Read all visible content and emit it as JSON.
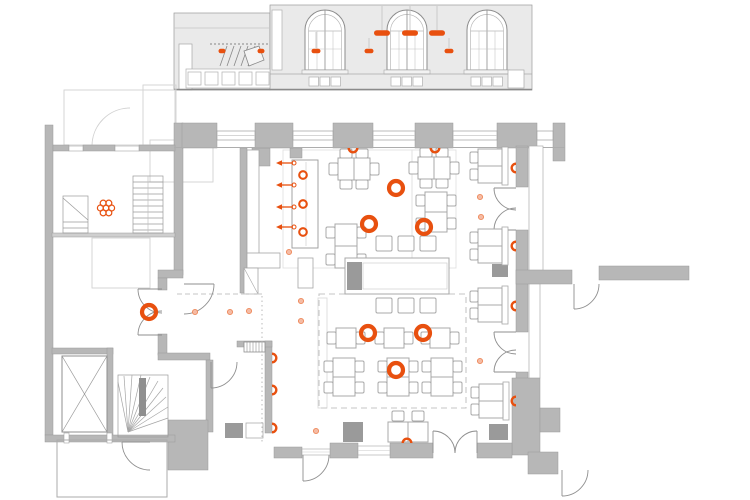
{
  "colors": {
    "accent": "#e8500f",
    "accent_soft": "#f5bba4",
    "accent_soft_edge": "#ee8a5c",
    "wall": "#b7b7b7",
    "furniture_line": "#a8a8a8",
    "dark_block": "#9a9a9a"
  },
  "section": {
    "pendants_large": [
      [
        382,
        33
      ],
      [
        410,
        33
      ],
      [
        437,
        33
      ]
    ],
    "pendants_small": [
      [
        316,
        51
      ],
      [
        369,
        51
      ],
      [
        449,
        51
      ]
    ],
    "wall_dots": [
      [
        222,
        51
      ],
      [
        261,
        51
      ]
    ]
  },
  "plan": {
    "pendant_rings": [
      [
        396,
        188
      ],
      [
        369,
        224
      ],
      [
        424,
        227
      ],
      [
        368,
        333
      ],
      [
        423,
        333
      ],
      [
        396,
        370
      ],
      [
        149,
        312
      ]
    ],
    "counter_rings": [
      [
        303,
        175
      ],
      [
        303,
        204
      ],
      [
        303,
        232
      ]
    ],
    "wall_lights": [
      {
        "x": 353,
        "y": 148,
        "dir": "down"
      },
      {
        "x": 435,
        "y": 148,
        "dir": "down"
      },
      {
        "x": 516,
        "y": 168,
        "dir": "left"
      },
      {
        "x": 516,
        "y": 246,
        "dir": "left"
      },
      {
        "x": 516,
        "y": 306,
        "dir": "left"
      },
      {
        "x": 516,
        "y": 401,
        "dir": "left"
      },
      {
        "x": 272,
        "y": 358,
        "dir": "right"
      },
      {
        "x": 272,
        "y": 390,
        "dir": "right"
      },
      {
        "x": 272,
        "y": 428,
        "dir": "right"
      },
      {
        "x": 407,
        "y": 443,
        "dir": "up"
      }
    ],
    "spot_dots": [
      [
        195,
        312
      ],
      [
        230,
        312
      ],
      [
        249,
        311
      ],
      [
        301,
        301
      ],
      [
        301,
        321
      ],
      [
        289,
        252
      ],
      [
        480,
        197
      ],
      [
        481,
        217
      ],
      [
        480,
        361
      ],
      [
        316,
        431
      ]
    ],
    "arrows": {
      "tip_x": 276,
      "tail_x": 293,
      "ys": [
        163,
        185,
        207,
        227
      ]
    },
    "plant": {
      "x": 106,
      "y": 208
    },
    "furniture": {
      "clusters": [
        {
          "type": "t6",
          "x": 354,
          "y": 169
        },
        {
          "type": "t6",
          "x": 434,
          "y": 168
        },
        {
          "type": "t4v",
          "x": 346,
          "y": 246,
          "h": 44
        },
        {
          "type": "t4v",
          "x": 436,
          "y": 212,
          "h": 40
        },
        {
          "type": "t2",
          "x": 346,
          "y": 338
        },
        {
          "type": "t2",
          "x": 394,
          "y": 338
        },
        {
          "type": "t2",
          "x": 440,
          "y": 338
        },
        {
          "type": "t4v",
          "x": 344,
          "y": 377,
          "h": 38
        },
        {
          "type": "t4v",
          "x": 398,
          "y": 377,
          "h": 38
        },
        {
          "type": "t4v",
          "x": 442,
          "y": 377,
          "h": 38
        },
        {
          "type": "b2",
          "x": 490,
          "y": 166
        },
        {
          "type": "b2",
          "x": 490,
          "y": 246
        },
        {
          "type": "b2",
          "x": 490,
          "y": 305
        },
        {
          "type": "b2",
          "x": 491,
          "y": 401
        },
        {
          "type": "st2",
          "x": 408,
          "y": 432
        },
        {
          "type": "communal",
          "x": 397,
          "y": 276
        }
      ]
    }
  }
}
